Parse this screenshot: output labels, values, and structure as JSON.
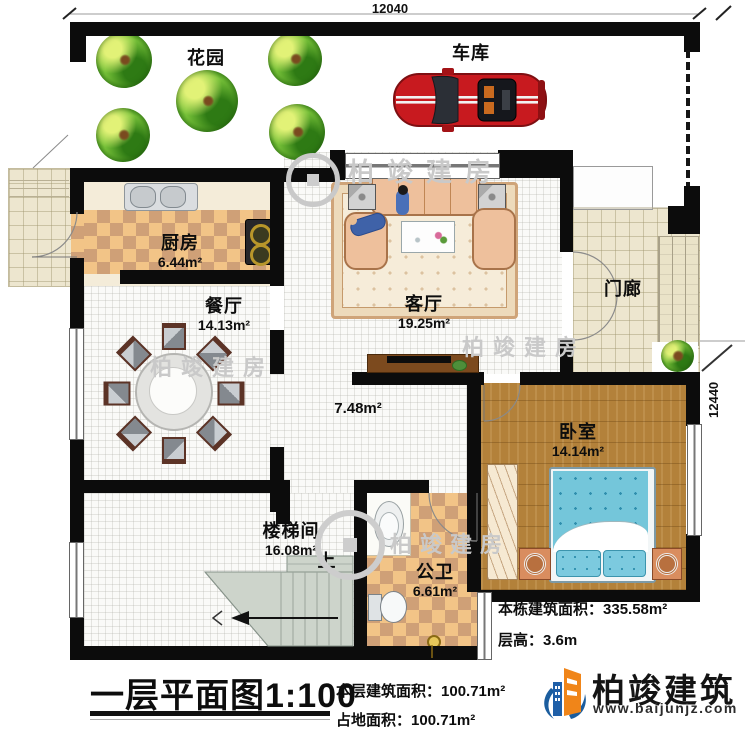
{
  "plan": {
    "title": "一层平面图",
    "scale": "1:100",
    "dim_top": "12040",
    "dim_right": "12440"
  },
  "rooms": {
    "garden": {
      "name": "花园"
    },
    "garage": {
      "name": "车库"
    },
    "kitchen": {
      "name": "厨房",
      "area": "6.44m²"
    },
    "dining": {
      "name": "餐厅",
      "area": "14.13m²"
    },
    "living": {
      "name": "客厅",
      "area": "19.25m²"
    },
    "porch": {
      "name": "门廊"
    },
    "hallway": {
      "area": "7.48m²"
    },
    "bedroom": {
      "name": "卧室",
      "area": "14.14m²"
    },
    "stairwell": {
      "name": "楼梯间",
      "area": "16.08m²"
    },
    "bathroom": {
      "name": "公卫",
      "area": "6.61m²"
    },
    "stairs_up": "上"
  },
  "stats": {
    "building_total": {
      "label": "本栋建筑面积：",
      "value": "335.58m²"
    },
    "floor_height": {
      "label": "层高：",
      "value": "3.6m"
    },
    "floor_area": {
      "label": "本层建筑面积：",
      "value": "100.71m²"
    },
    "footprint": {
      "label": "占地面积：",
      "value": "100.71m²"
    }
  },
  "brand": {
    "name": "柏竣建筑",
    "website": "www.baijunjz.com"
  },
  "watermark": {
    "text": "柏竣建房"
  },
  "colors": {
    "wall": "#0c0c0c",
    "checker_light": "#f2c487",
    "checker_dark": "#cfa077",
    "wood": "#b3813a",
    "bed_blue": "#74c6da",
    "brand_orange": "#f08519",
    "brand_blue": "#1b5d9e"
  }
}
